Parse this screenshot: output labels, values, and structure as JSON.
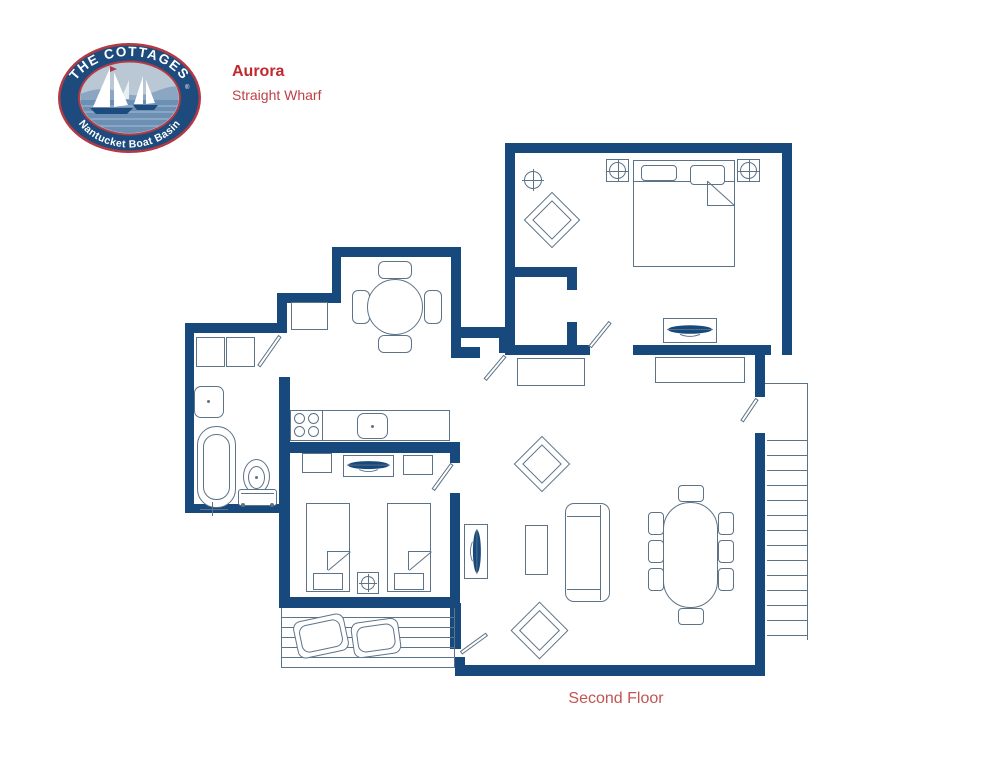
{
  "header": {
    "logo": {
      "top_text": "THE COTTAGES",
      "trademark": "®",
      "bottom_text": "Nantucket Boat Basin"
    },
    "title": "Aurora",
    "subtitle": "Straight Wharf"
  },
  "footer": {
    "floor_label": "Second Floor"
  },
  "colors": {
    "wall": "#17497c",
    "line": "#5d7387",
    "red": "#c2282e",
    "red2": "#bf4043",
    "red3": "#c05553"
  },
  "plan": {
    "elements": [
      {
        "t": "wall",
        "n": "wall-master-top",
        "x": 505,
        "y": 143,
        "w": 287,
        "h": 10
      },
      {
        "t": "wall",
        "n": "wall-master-right",
        "x": 782,
        "y": 143,
        "w": 10,
        "h": 212
      },
      {
        "t": "wall",
        "n": "wall-master-left",
        "x": 505,
        "y": 143,
        "w": 10,
        "h": 212
      },
      {
        "t": "wall",
        "n": "wall-master-bottom-west",
        "x": 505,
        "y": 345,
        "w": 85,
        "h": 10
      },
      {
        "t": "wall",
        "n": "wall-master-bottom-east",
        "x": 633,
        "y": 345,
        "w": 138,
        "h": 10
      },
      {
        "t": "wall",
        "n": "wall-closet-top",
        "x": 515,
        "y": 267,
        "w": 62,
        "h": 10
      },
      {
        "t": "wall",
        "n": "wall-closet-stub-north",
        "x": 567,
        "y": 277,
        "w": 10,
        "h": 13
      },
      {
        "t": "wall",
        "n": "wall-closet-stub-south",
        "x": 567,
        "y": 322,
        "w": 10,
        "h": 23
      },
      {
        "t": "wall",
        "n": "wall-nook-top",
        "x": 332,
        "y": 247,
        "w": 129,
        "h": 10
      },
      {
        "t": "wall",
        "n": "wall-nook-left",
        "x": 332,
        "y": 247,
        "w": 9,
        "h": 46
      },
      {
        "t": "wall",
        "n": "wall-alcove-top",
        "x": 277,
        "y": 293,
        "w": 64,
        "h": 10
      },
      {
        "t": "wall",
        "n": "wall-alcove-left",
        "x": 277,
        "y": 303,
        "w": 10,
        "h": 20
      },
      {
        "t": "wall",
        "n": "wall-hall-west",
        "x": 451,
        "y": 247,
        "w": 10,
        "h": 111
      },
      {
        "t": "wall",
        "n": "wall-hall-south-upper",
        "x": 461,
        "y": 327,
        "w": 40,
        "h": 11
      },
      {
        "t": "wall",
        "n": "wall-hall-stub",
        "x": 499,
        "y": 327,
        "w": 12,
        "h": 26
      },
      {
        "t": "wall",
        "n": "wall-hall-south-lower",
        "x": 451,
        "y": 347,
        "w": 29,
        "h": 11
      },
      {
        "t": "wall",
        "n": "wall-bath-top",
        "x": 185,
        "y": 323,
        "w": 102,
        "h": 10
      },
      {
        "t": "wall",
        "n": "wall-bath-left",
        "x": 185,
        "y": 323,
        "w": 9,
        "h": 190
      },
      {
        "t": "wall",
        "n": "wall-bath-bottom",
        "x": 185,
        "y": 504,
        "w": 105,
        "h": 9
      },
      {
        "t": "wall",
        "n": "wall-bath-bed2-east",
        "x": 279,
        "y": 377,
        "w": 11,
        "h": 231
      },
      {
        "t": "wall",
        "n": "wall-kitchen-south",
        "x": 279,
        "y": 442,
        "w": 181,
        "h": 11
      },
      {
        "t": "wall",
        "n": "wall-bed2-bottom",
        "x": 279,
        "y": 597,
        "w": 178,
        "h": 11
      },
      {
        "t": "wall",
        "n": "wall-bed2-right-north",
        "x": 450,
        "y": 442,
        "w": 10,
        "h": 21
      },
      {
        "t": "wall",
        "n": "wall-bed2-right-south",
        "x": 450,
        "y": 493,
        "w": 10,
        "h": 110
      },
      {
        "t": "wall",
        "n": "wall-deck-east",
        "x": 450,
        "y": 603,
        "w": 11,
        "h": 46
      },
      {
        "t": "wall",
        "n": "wall-living-sw-corner",
        "x": 455,
        "y": 657,
        "w": 10,
        "h": 19
      },
      {
        "t": "wall",
        "n": "wall-living-bottom",
        "x": 455,
        "y": 665,
        "w": 310,
        "h": 11
      },
      {
        "t": "wall",
        "n": "wall-living-right",
        "x": 755,
        "y": 433,
        "w": 10,
        "h": 243
      },
      {
        "t": "wall",
        "n": "wall-stair-stub",
        "x": 755,
        "y": 352,
        "w": 10,
        "h": 45
      },
      {
        "t": "rect",
        "n": "bath-cabinet",
        "x": 196,
        "y": 337,
        "w": 29,
        "h": 30
      },
      {
        "t": "rect",
        "n": "bath-cabinet",
        "x": 226,
        "y": 337,
        "w": 29,
        "h": 30
      },
      {
        "t": "rect",
        "n": "bath-sink",
        "x": 194,
        "y": 386,
        "w": 30,
        "h": 32,
        "r": 7
      },
      {
        "t": "dot",
        "n": "bath-sink-drain",
        "x": 207,
        "y": 400,
        "d": 3
      },
      {
        "t": "rect",
        "n": "bathtub-outer",
        "x": 197,
        "y": 426,
        "w": 39,
        "h": 82,
        "r": 19
      },
      {
        "t": "rect",
        "n": "bathtub-inner",
        "x": 203,
        "y": 434,
        "w": 27,
        "h": 66,
        "r": 13
      },
      {
        "t": "line",
        "n": "bathtub-faucet",
        "x": 200,
        "y": 509,
        "len": 28,
        "a": 0
      },
      {
        "t": "line",
        "n": "bathtub-faucet",
        "x": 213,
        "y": 502,
        "len": 14,
        "a": 90
      },
      {
        "t": "rect",
        "n": "toilet-bowl",
        "x": 243,
        "y": 459,
        "w": 27,
        "h": 35,
        "r": "50%"
      },
      {
        "t": "rect",
        "n": "toilet-bowl-inner",
        "x": 248,
        "y": 466,
        "w": 17,
        "h": 23,
        "r": "50%"
      },
      {
        "t": "dot",
        "n": "toilet-drain",
        "x": 255,
        "y": 476,
        "d": 3
      },
      {
        "t": "rect",
        "n": "toilet-tank",
        "x": 238,
        "y": 489,
        "w": 39,
        "h": 17,
        "r": 3
      },
      {
        "t": "line",
        "n": "toilet-tank-line",
        "x": 241,
        "y": 493,
        "len": 33,
        "a": 0
      },
      {
        "t": "dot",
        "n": "toilet-foot",
        "x": 241,
        "y": 503,
        "d": 4
      },
      {
        "t": "dot",
        "n": "toilet-foot",
        "x": 270,
        "y": 503,
        "d": 4
      },
      {
        "t": "leaf",
        "n": "bath-door",
        "x": 280,
        "y": 334,
        "len": 37,
        "a": 125
      },
      {
        "t": "rect",
        "n": "alcove-cabinet",
        "x": 291,
        "y": 302,
        "w": 37,
        "h": 28
      },
      {
        "t": "rect",
        "n": "nook-chair",
        "x": 378,
        "y": 261,
        "w": 34,
        "h": 18,
        "r": 6
      },
      {
        "t": "rect",
        "n": "nook-chair",
        "x": 378,
        "y": 335,
        "w": 34,
        "h": 18,
        "r": 6
      },
      {
        "t": "rect",
        "n": "nook-chair",
        "x": 352,
        "y": 290,
        "w": 18,
        "h": 34,
        "r": 6
      },
      {
        "t": "rect",
        "n": "nook-chair",
        "x": 424,
        "y": 290,
        "w": 18,
        "h": 34,
        "r": 6
      },
      {
        "t": "circle",
        "n": "nook-table",
        "x": 367,
        "y": 279,
        "d": 56
      },
      {
        "t": "rect",
        "n": "kitchen-counter",
        "x": 290,
        "y": 410,
        "w": 160,
        "h": 31
      },
      {
        "t": "line",
        "n": "stove-divider",
        "x": 323,
        "y": 410,
        "len": 31,
        "a": 90
      },
      {
        "t": "circle",
        "n": "stove-burner",
        "x": 294,
        "y": 413,
        "d": 11
      },
      {
        "t": "circle",
        "n": "stove-burner",
        "x": 308,
        "y": 413,
        "d": 11
      },
      {
        "t": "circle",
        "n": "stove-burner",
        "x": 294,
        "y": 426,
        "d": 11
      },
      {
        "t": "circle",
        "n": "stove-burner",
        "x": 308,
        "y": 426,
        "d": 11
      },
      {
        "t": "rect",
        "n": "kitchen-sink",
        "x": 357,
        "y": 413,
        "w": 31,
        "h": 26,
        "r": 7
      },
      {
        "t": "dot",
        "n": "kitchen-sink-drain",
        "x": 371,
        "y": 425,
        "d": 3
      },
      {
        "t": "rect",
        "n": "bed2-nightstand",
        "x": 302,
        "y": 453,
        "w": 30,
        "h": 20
      },
      {
        "t": "rect",
        "n": "bed2-dresser",
        "x": 343,
        "y": 455,
        "w": 51,
        "h": 22
      },
      {
        "t": "tv",
        "n": "bed2-tv-icon",
        "x": 346,
        "y": 458,
        "w": 45,
        "h": 16
      },
      {
        "t": "rect",
        "n": "bed2-nightstand",
        "x": 403,
        "y": 455,
        "w": 30,
        "h": 20
      },
      {
        "t": "rect",
        "n": "twin-bed",
        "x": 306,
        "y": 503,
        "w": 44,
        "h": 89
      },
      {
        "t": "rect",
        "n": "twin-bed-footboard",
        "x": 313,
        "y": 573,
        "w": 30,
        "h": 17
      },
      {
        "t": "line",
        "n": "twin-bed-fold",
        "x": 328,
        "y": 551,
        "len": 22,
        "a": 0
      },
      {
        "t": "line",
        "n": "twin-bed-fold",
        "x": 328,
        "y": 551,
        "len": 19,
        "a": 90
      },
      {
        "t": "line",
        "n": "twin-bed-fold",
        "x": 328,
        "y": 570,
        "len": 29,
        "a": -40
      },
      {
        "t": "rect",
        "n": "twin-bed",
        "x": 387,
        "y": 503,
        "w": 44,
        "h": 89
      },
      {
        "t": "rect",
        "n": "twin-bed-footboard",
        "x": 394,
        "y": 573,
        "w": 30,
        "h": 17
      },
      {
        "t": "line",
        "n": "twin-bed-fold",
        "x": 409,
        "y": 551,
        "len": 22,
        "a": 0
      },
      {
        "t": "line",
        "n": "twin-bed-fold",
        "x": 409,
        "y": 551,
        "len": 19,
        "a": 90
      },
      {
        "t": "line",
        "n": "twin-bed-fold",
        "x": 409,
        "y": 570,
        "len": 29,
        "a": -40
      },
      {
        "t": "rect",
        "n": "ceiling-fixture-box",
        "x": 357,
        "y": 572,
        "w": 22,
        "h": 22
      },
      {
        "t": "ccross",
        "n": "ceiling-fixture-icon",
        "x": 361,
        "y": 576,
        "d": 14
      },
      {
        "t": "leaf",
        "n": "bed2-door",
        "x": 452,
        "y": 462,
        "len": 32,
        "a": 126
      },
      {
        "t": "rect",
        "n": "living-tv-console",
        "x": 464,
        "y": 524,
        "w": 24,
        "h": 55
      },
      {
        "t": "tv",
        "n": "living-tv-icon",
        "x": 468,
        "y": 528,
        "w": 16,
        "h": 47,
        "v": 1
      },
      {
        "t": "ccross",
        "n": "master-ceiling-fixture-icon",
        "x": 524,
        "y": 171,
        "d": 18
      },
      {
        "t": "diamond",
        "n": "master-corner-chair",
        "x": 532,
        "y": 200,
        "s": 40
      },
      {
        "t": "rect",
        "n": "master-lamp-box",
        "x": 606,
        "y": 159,
        "w": 23,
        "h": 23
      },
      {
        "t": "ccross",
        "n": "master-lamp-icon",
        "x": 609,
        "y": 162,
        "d": 17
      },
      {
        "t": "rect",
        "n": "master-lamp-box",
        "x": 737,
        "y": 159,
        "w": 23,
        "h": 23
      },
      {
        "t": "ccross",
        "n": "master-lamp-icon",
        "x": 740,
        "y": 162,
        "d": 17
      },
      {
        "t": "rect",
        "n": "master-bed",
        "x": 633,
        "y": 160,
        "w": 102,
        "h": 107
      },
      {
        "t": "line",
        "n": "master-bed-headboard",
        "x": 633,
        "y": 181,
        "len": 102,
        "a": 0
      },
      {
        "t": "rect",
        "n": "master-bed-pillow",
        "x": 641,
        "y": 165,
        "w": 36,
        "h": 16,
        "r": 4
      },
      {
        "t": "rect",
        "n": "master-bed-pillow",
        "x": 690,
        "y": 165,
        "w": 35,
        "h": 20,
        "r": 4
      },
      {
        "t": "line",
        "n": "master-bed-fold",
        "x": 708,
        "y": 181,
        "len": 25,
        "a": 90
      },
      {
        "t": "line",
        "n": "master-bed-fold",
        "x": 708,
        "y": 205,
        "len": 27,
        "a": 0
      },
      {
        "t": "line",
        "n": "master-bed-fold",
        "x": 708,
        "y": 181,
        "len": 36,
        "a": 42
      },
      {
        "t": "rect",
        "n": "master-dresser",
        "x": 663,
        "y": 318,
        "w": 54,
        "h": 25
      },
      {
        "t": "tv",
        "n": "master-tv-icon",
        "x": 666,
        "y": 322,
        "w": 48,
        "h": 17
      },
      {
        "t": "leaf",
        "n": "master-door",
        "x": 590,
        "y": 345,
        "len": 32,
        "a": -51
      },
      {
        "t": "rect",
        "n": "hall-console",
        "x": 517,
        "y": 358,
        "w": 68,
        "h": 28
      },
      {
        "t": "rect",
        "n": "living-console",
        "x": 655,
        "y": 357,
        "w": 90,
        "h": 26
      },
      {
        "t": "leaf",
        "n": "hall-door",
        "x": 505,
        "y": 354,
        "len": 31,
        "a": 130
      },
      {
        "t": "leaf",
        "n": "stair-door",
        "x": 757,
        "y": 397,
        "len": 27,
        "a": 124
      },
      {
        "t": "diamond",
        "n": "living-accent-chair",
        "x": 522,
        "y": 444,
        "s": 40
      },
      {
        "t": "diamond",
        "n": "living-accent-chair",
        "x": 519,
        "y": 610,
        "s": 41
      },
      {
        "t": "rect",
        "n": "coffee-table",
        "x": 525,
        "y": 525,
        "w": 23,
        "h": 50
      },
      {
        "t": "rect",
        "n": "sofa",
        "x": 565,
        "y": 503,
        "w": 45,
        "h": 99,
        "r": 9
      },
      {
        "t": "line",
        "n": "sofa-back",
        "x": 601,
        "y": 505,
        "len": 95,
        "a": 90
      },
      {
        "t": "line",
        "n": "sofa-arm",
        "x": 567,
        "y": 516,
        "len": 34,
        "a": 0
      },
      {
        "t": "line",
        "n": "sofa-arm",
        "x": 567,
        "y": 589,
        "len": 34,
        "a": 0
      },
      {
        "t": "rect",
        "n": "dining-chair",
        "x": 678,
        "y": 485,
        "w": 26,
        "h": 17,
        "r": 4
      },
      {
        "t": "rect",
        "n": "dining-chair",
        "x": 678,
        "y": 608,
        "w": 26,
        "h": 17,
        "r": 4
      },
      {
        "t": "rect",
        "n": "dining-chair",
        "x": 648,
        "y": 512,
        "w": 16,
        "h": 23,
        "r": 4
      },
      {
        "t": "rect",
        "n": "dining-chair",
        "x": 648,
        "y": 540,
        "w": 16,
        "h": 23,
        "r": 4
      },
      {
        "t": "rect",
        "n": "dining-chair",
        "x": 648,
        "y": 568,
        "w": 16,
        "h": 23,
        "r": 4
      },
      {
        "t": "rect",
        "n": "dining-chair",
        "x": 718,
        "y": 512,
        "w": 16,
        "h": 23,
        "r": 4
      },
      {
        "t": "rect",
        "n": "dining-chair",
        "x": 718,
        "y": 540,
        "w": 16,
        "h": 23,
        "r": 4
      },
      {
        "t": "rect",
        "n": "dining-chair",
        "x": 718,
        "y": 568,
        "w": 16,
        "h": 23,
        "r": 4
      },
      {
        "t": "rect",
        "n": "dining-table",
        "x": 663,
        "y": 502,
        "w": 55,
        "h": 106,
        "r": 27
      },
      {
        "t": "leaf",
        "n": "deck-door",
        "x": 461,
        "y": 651,
        "len": 32,
        "a": -36
      },
      {
        "t": "line",
        "n": "stair-landing-edge",
        "x": 765,
        "y": 383,
        "len": 43,
        "a": 0
      },
      {
        "t": "line",
        "n": "stair-rail",
        "x": 808,
        "y": 383,
        "len": 257,
        "a": 90
      },
      {
        "t": "stairs",
        "n": "staircase-treads",
        "x": 767,
        "y": 440,
        "w": 41,
        "h": 196
      },
      {
        "t": "planks",
        "n": "deck-floor",
        "x": 281,
        "y": 608,
        "w": 174,
        "h": 60
      },
      {
        "t": "rect",
        "n": "deck-chair",
        "x": 295,
        "y": 617,
        "w": 52,
        "h": 38,
        "r": 8,
        "rot": -12,
        "dbl": 1
      },
      {
        "t": "rect",
        "n": "deck-chair",
        "x": 352,
        "y": 620,
        "w": 48,
        "h": 36,
        "r": 8,
        "rot": -8,
        "dbl": 1
      }
    ]
  }
}
